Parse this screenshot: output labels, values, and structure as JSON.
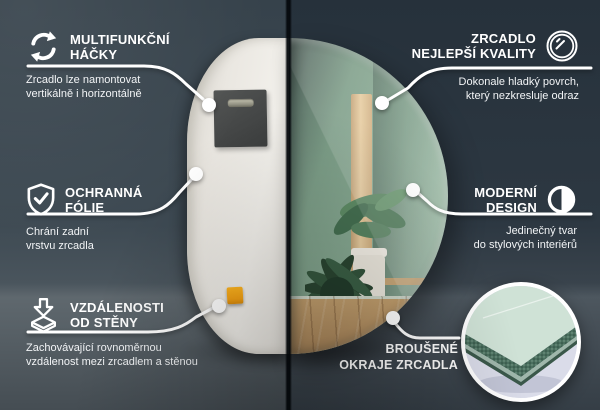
{
  "callouts": {
    "hooks": {
      "icon": "rotate-arrows-icon",
      "title": "MULTIFUNKČNÍ\nHÁČKY",
      "desc": "Zrcadlo lze namontovat\nvertikálně i horizontálně"
    },
    "protective_film": {
      "icon": "shield-check-icon",
      "title": "OCHRANNÁ\nFÓLIE",
      "desc": "Chrání zadní\nvrstvu zrcadla"
    },
    "wall_distance": {
      "icon": "distance-arrow-icon",
      "title": "VZDÁLENOSTI\nOD STĚNY",
      "desc": "Zachovávající rovnoměrnou\nvzdálenost mezi zrcadlem a stěnou"
    },
    "quality": {
      "icon": "mirror-shine-icon",
      "title": "ZRCADLO\nNEJLEPŠÍ KVALITY",
      "desc": "Dokonale hladký povrch,\nkterý nezkresluje odraz"
    },
    "design": {
      "icon": "half-circle-design-icon",
      "title": "MODERNÍ\nDESIGN",
      "desc": "Jedinečný tvar\ndo stylových interiérů"
    },
    "edges": {
      "label": "BROUŠENÉ\nOKRAJE ZRCADLA"
    }
  },
  "colors": {
    "background_left": "#3a4650",
    "background_right": "#283039",
    "mirror_back": "#edeae5",
    "reflection_green": "#8aab94",
    "accent_white": "#ffffff",
    "spacer_orange": "#f6a91c",
    "hook_patch_gray": "#474a49",
    "edge_green": "#4a6f5e",
    "inset_lavender": "#dadce9"
  }
}
